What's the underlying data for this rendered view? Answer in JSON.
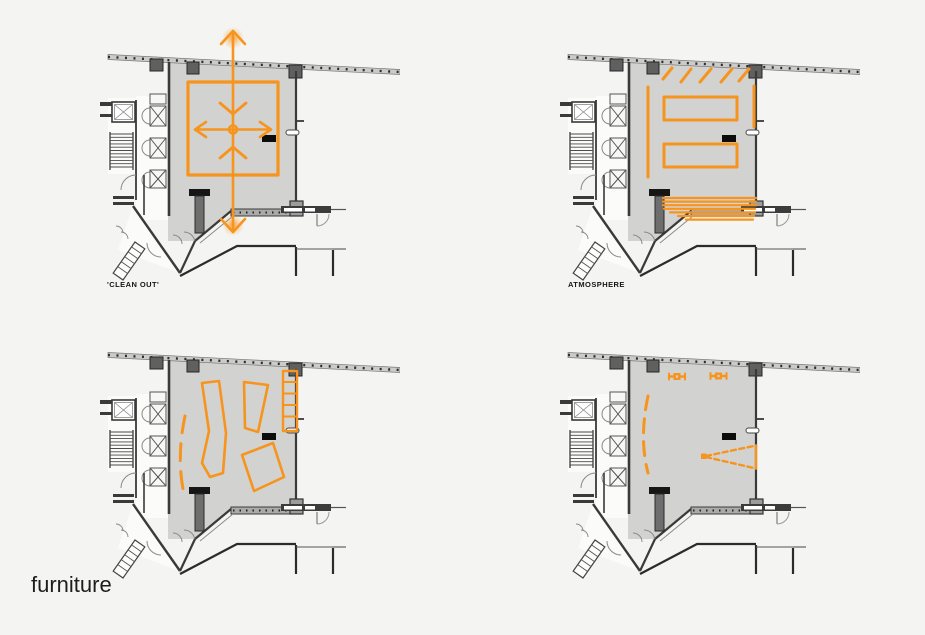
{
  "palette": {
    "accent": "#f7941d",
    "room_fill": "#d2d2d1",
    "wall": "#3a3a3a",
    "background": "#f4f4f2",
    "label_color": "#161616"
  },
  "plans": [
    {
      "id": "clean-out",
      "label": "'CLEAN OUT'"
    },
    {
      "id": "atmosphere",
      "label": "ATMOSPHERE"
    },
    {
      "id": "furniture-layout",
      "label": ""
    },
    {
      "id": "lighting-projection",
      "label": ""
    }
  ],
  "caption": "furniture"
}
